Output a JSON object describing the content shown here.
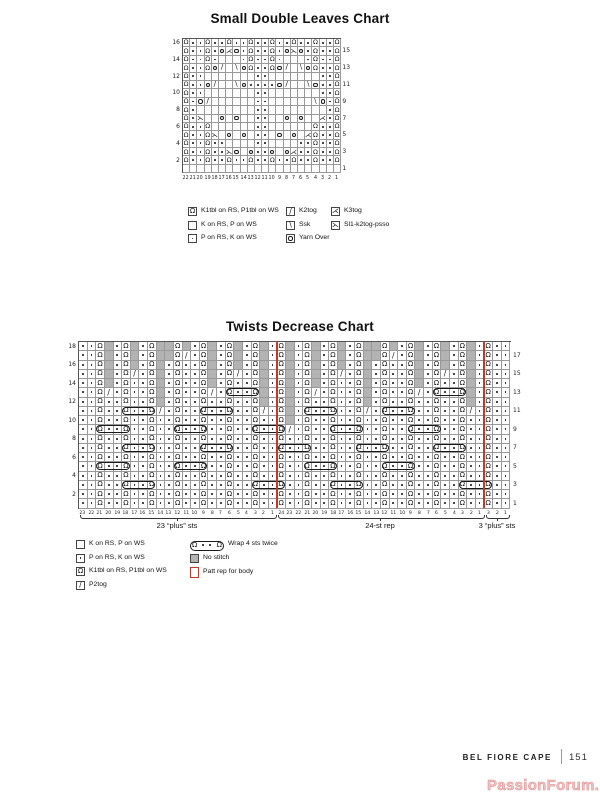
{
  "chart1": {
    "title": "Small Double Leaves Chart",
    "rows_top_to_bottom": [
      "Q..Q..Q..Q..Q..Q..Q..Q",
      "Q..Q.oJo.Q..Q.oLo.Q..Q",
      "Q..Q.   .Q..Q.   .Q..Q",
      "Q..Qo/ \\oQ..Qo/ \\oQ..Q",
      "Q..       ..       ..Q",
      "Q..o/  \\o....o/  \\o..Q",
      "Q..       ..       ..Q",
      "Q.o/      ..      \\o.Q",
      "Q.        ..        .Q",
      "Q.L  o o  ..  o o  J.Q",
      "Q..Q      ..      Q..Q",
      "Q..QL o o .. o o JQ..Q",
      "Q..Q..    ..    ..Q..Q",
      "Q..Q..Lo o..o oJ..Q..Q",
      "Q..Q..Q..Q..Q..Q..Q..Q",
      "                      "
    ],
    "left_labels": [
      16,
      14,
      12,
      10,
      8,
      6,
      4,
      2
    ],
    "right_labels": [
      15,
      13,
      11,
      9,
      7,
      5,
      3,
      1
    ],
    "bottom_labels": [
      22,
      21,
      20,
      19,
      18,
      17,
      16,
      15,
      14,
      13,
      12,
      11,
      10,
      9,
      8,
      7,
      6,
      5,
      4,
      3,
      2,
      1
    ],
    "legend_col1": [
      {
        "sym": "Q",
        "label": "K1tbl on RS, P1tbl on WS"
      },
      {
        "sym": " ",
        "label": "K on RS, P on WS"
      },
      {
        "sym": ".",
        "label": "P on RS, K on WS"
      }
    ],
    "legend_col2": [
      {
        "sym": "/",
        "label": "K2tog"
      },
      {
        "sym": "\\",
        "label": "Ssk"
      },
      {
        "sym": "o",
        "label": "Yarn Over"
      }
    ],
    "legend_col3": [
      {
        "sym": "J",
        "label": "K3tog"
      },
      {
        "sym": "L",
        "label": "Sl1-k2tog-psso"
      }
    ]
  },
  "chart2": {
    "title": "Twists Decrease Chart",
    "rows_top_to_bottom": [
      "..Q#.Q#.Q##Q#.Q#.Q#.Q#.Q#.Q#.Q#.Q##Q#.Q#.Q#.Q#.Q..",
      "..Q#.Q#.Q##Q/.Q#.Q#.Q#.Q#.Q#.Q#.Q##Q/.Q#.Q#.Q#.Q..",
      "..Q#.Q#.Q#.Q..Q#.Q#.Q#.Q#.Q#.Q#.Q#.Q..Q#.Q#.Q#.Q..",
      "..Q#.Q/.Q#.Q..Q#.Q/.Q#.Q#.Q#.Q/.Q#.Q..Q#.Q/.Q#.Q..",
      "..Q#.Q..Q#.Q..Q#.Q..Q#.Q#.Q#.Q..Q#.Q..Q#.Q..Q#.Q..",
      "..Q/.Q..Q#.Q..Q/.Q..Q#.Q#.Q/.Q..Q#.Q..Q/.Q..Q#.Q..",
      "..Q..Q..Q#.Q..Q..Q..Q#.Q#.Q..Q..Q#.Q..Q..Q..Q#.Q..",
      "..Q..Q..Q/.Q..Q..Q..Q/.Q#.Q..Q..Q/.Q..Q..Q..Q/.Q..",
      "..Q..Q..Q..Q..Q..Q..Q..Q#.Q..Q..Q..Q..Q..Q..Q..Q..",
      "..Q..Q..Q..Q..Q..Q..Q..Q/.Q..Q..Q..Q..Q..Q..Q..Q..",
      "..Q..Q..Q..Q..Q..Q..Q..Q..Q..Q..Q..Q..Q..Q..Q..Q..",
      "..Q..Q..Q..Q..Q..Q..Q..Q..Q..Q..Q..Q..Q..Q..Q..Q..",
      "..Q..Q..Q..Q..Q..Q..Q..Q..Q..Q..Q..Q..Q..Q..Q..Q..",
      "..Q..Q..Q..Q..Q..Q..Q..Q..Q..Q..Q..Q..Q..Q..Q..Q..",
      "..Q..Q..Q..Q..Q..Q..Q..Q..Q..Q..Q..Q..Q..Q..Q..Q..",
      "..Q..Q..Q..Q..Q..Q..Q..Q..Q..Q..Q..Q..Q..Q..Q..Q..",
      "..Q..Q..Q..Q..Q..Q..Q..Q..Q..Q..Q..Q..Q..Q..Q..Q..",
      "..Q..Q..Q..Q..Q..Q..Q..Q..Q..Q..Q..Q..Q..Q..Q..Q.."
    ],
    "wraps_by_row": {
      "3": [
        5,
        20,
        29,
        44
      ],
      "5": [
        2,
        11,
        26,
        35
      ],
      "7": [
        5,
        14,
        23,
        32,
        41
      ],
      "9": [
        2,
        11,
        20,
        29,
        38
      ],
      "11": [
        5,
        14,
        26,
        35
      ],
      "13": [
        17,
        41
      ]
    },
    "rep_boundaries": [
      23,
      47
    ],
    "red_color": "#c0392b",
    "no_stitch_color": "#b3b3b3",
    "left_labels": [
      18,
      16,
      14,
      12,
      10,
      8,
      6,
      4,
      2
    ],
    "right_labels": [
      17,
      15,
      13,
      11,
      9,
      7,
      5,
      3,
      1
    ],
    "bottom_labels_left": [
      23,
      22,
      21,
      20,
      19,
      18,
      17,
      16,
      15,
      14,
      13,
      12,
      11,
      10,
      9,
      8,
      7,
      6,
      5,
      4,
      3,
      2,
      1
    ],
    "bottom_labels_rep": [
      24,
      23,
      22,
      21,
      20,
      19,
      18,
      17,
      16,
      15,
      14,
      13,
      12,
      11,
      10,
      9,
      8,
      7,
      6,
      5,
      4,
      3,
      2,
      1
    ],
    "bottom_labels_plus": [
      3,
      2,
      1
    ],
    "section_labels": [
      "23 “plus” sts",
      "24-st rep",
      "3 “plus” sts"
    ],
    "legend_col1": [
      {
        "sym": " ",
        "label": "K on RS, P on WS"
      },
      {
        "sym": ".",
        "label": "P on RS, K on WS"
      },
      {
        "sym": "Q",
        "label": "K1tbl on RS, P1tbl on WS"
      },
      {
        "sym": "/",
        "label": "P2tog"
      }
    ],
    "legend_col2": [
      {
        "sym": "wrap",
        "label": "Wrap 4 sts twice"
      },
      {
        "sym": "#",
        "label": "No stitch"
      },
      {
        "sym": "rep",
        "label": "Patt rep for body"
      }
    ]
  },
  "footer": {
    "book_title": "BEL FIORE CAPE",
    "page_number": "151"
  },
  "watermark": "PassionForum.ru"
}
